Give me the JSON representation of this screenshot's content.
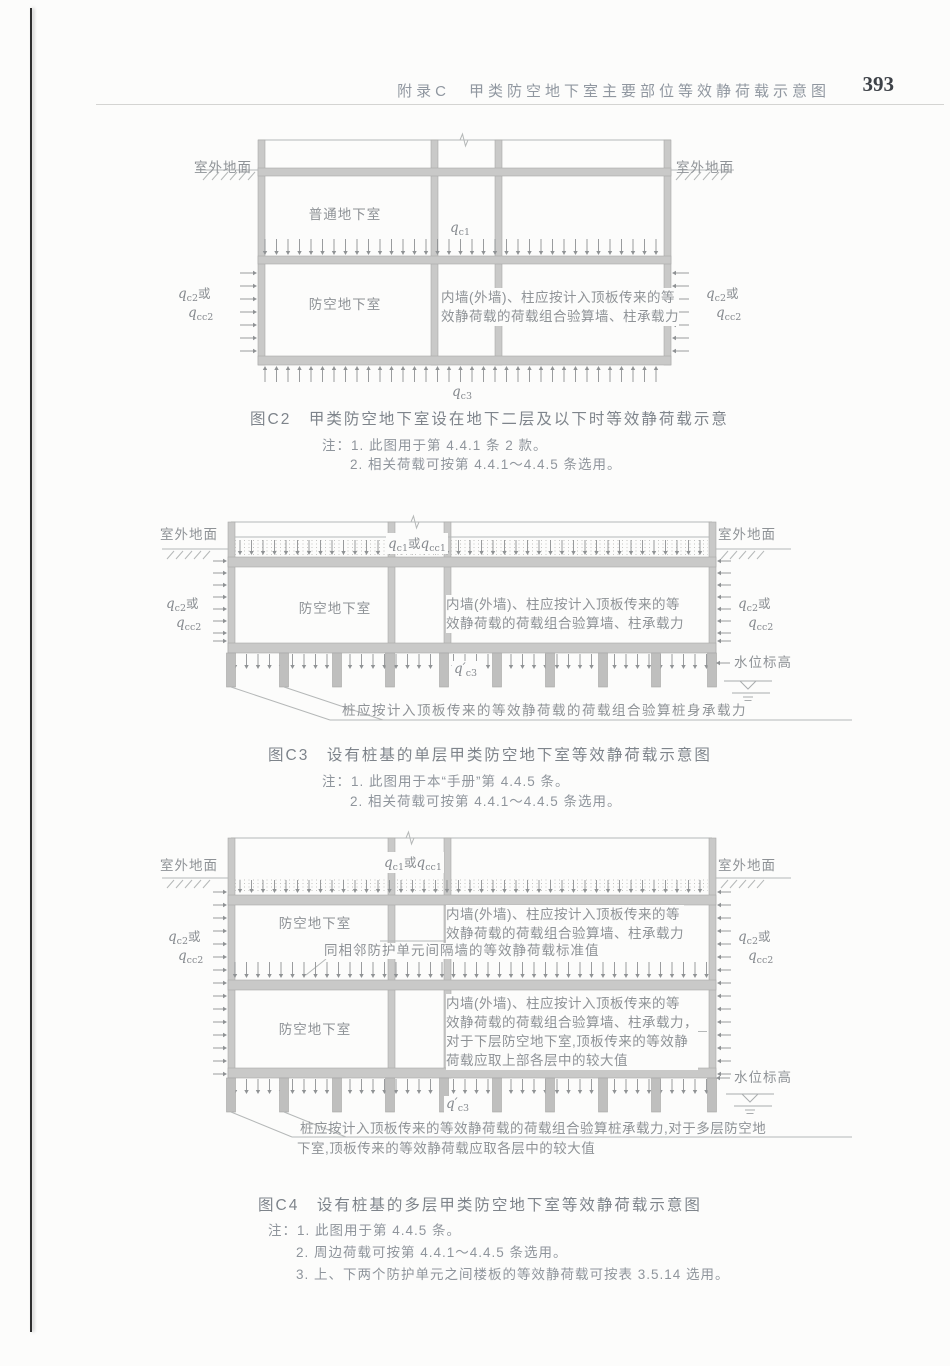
{
  "page": {
    "header_title": "附录C　甲类防空地下室主要部位等效静荷载示意图",
    "page_number": "393"
  },
  "shared": {
    "ground_surface": "室外地面",
    "ordinary_basement": "普通地下室",
    "defense_basement": "防空地下室",
    "water_level": "水位标高",
    "wall_note_line1": "内墙(外墙)、柱应按计入顶板传来的等",
    "wall_note_line2": "效静荷载的荷载组合验算墙、柱承载力"
  },
  "qlabels": {
    "qc1": [
      {
        "v": "q"
      },
      {
        "s": "c1"
      }
    ],
    "qc1_or_qcc1": [
      {
        "v": "q"
      },
      {
        "s": "c1"
      },
      {
        "t": "或"
      },
      {
        "v": "q"
      },
      {
        "s": "cc1"
      }
    ],
    "qc2_or": [
      {
        "v": "q"
      },
      {
        "s": "c2"
      },
      {
        "t": "或"
      }
    ],
    "qcc2": [
      {
        "v": "q"
      },
      {
        "s": "cc2"
      }
    ],
    "qc3": [
      {
        "v": "q"
      },
      {
        "s": "c3"
      }
    ],
    "qc3_prime": [
      {
        "v": "q′"
      },
      {
        "s": "c3"
      }
    ]
  },
  "fig_c2": {
    "caption": "图C2　甲类防空地下室设在地下二层及以下时等效静荷载示意",
    "notes": [
      "注：1. 此图用于第 4.4.1 条 2 款。",
      "2. 相关荷载可按第 4.4.1～4.4.5 条选用。"
    ]
  },
  "fig_c3": {
    "caption": "图C3　设有桩基的单层甲类防空地下室等效静荷载示意图",
    "pile_note": "桩应按计入顶板传来的等效静荷载的荷载组合验算桩身承载力",
    "notes": [
      "注：1. 此图用于本“手册”第 4.4.5 条。",
      "2. 相关荷载可按第 4.4.1～4.4.5 条选用。"
    ]
  },
  "fig_c4": {
    "caption": "图C4　设有桩基的多层甲类防空地下室等效静荷载示意图",
    "partition_note": "同相邻防护单元间隔墙的等效静荷载标准值",
    "lower_wall_note": [
      "内墙(外墙)、柱应按计入顶板传来的等",
      "效静荷载的荷载组合验算墙、柱承载力，",
      "对于下层防空地下室,顶板传来的等效静",
      "荷载应取上部各层中的较大值"
    ],
    "pile_note": [
      "桩应按计入顶板传来的等效静荷载的荷载组合验算桩承载力,对于多层防空地",
      "下室,顶板传来的等效静荷载应取各层中的较大值"
    ],
    "notes": [
      "注：1. 此图用于第 4.4.5 条。",
      "2. 周边荷载可按第 4.4.1～4.4.5 条选用。",
      "3. 上、下两个防护单元之间楼板的等效静荷载可按表 3.5.14 选用。"
    ]
  }
}
